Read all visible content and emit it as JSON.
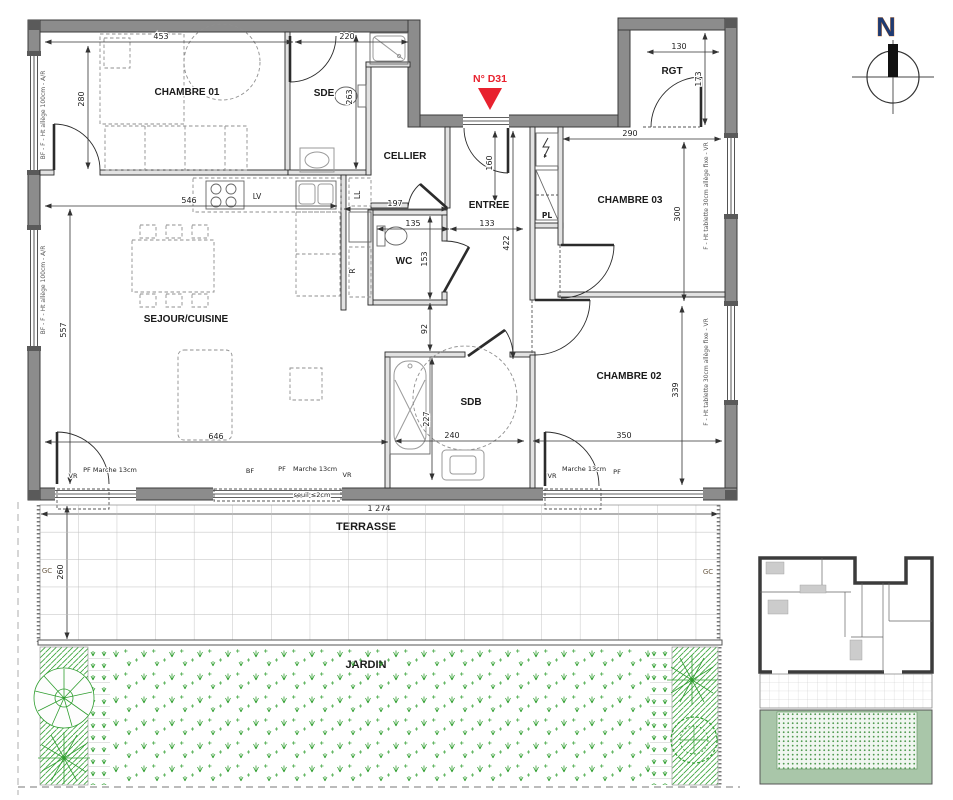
{
  "colors": {
    "wall_gray": "#8c8c8c",
    "marker_red": "#e8212e",
    "vegetation_green": "#2f9e2f",
    "north_blue": "#1f3b73"
  },
  "marker": {
    "label": "N° D31"
  },
  "compass": {
    "north": "N"
  },
  "rooms": {
    "chambre01": "CHAMBRE 01",
    "sde": "SDE",
    "cellier": "CELLIER",
    "entree": "ENTREE",
    "pl": "PL",
    "rgt": "RGT",
    "chambre03": "CHAMBRE 03",
    "wc": "WC",
    "sejour": "SEJOUR/CUISINE",
    "sdb": "SDB",
    "chambre02": "CHAMBRE 02",
    "terrasse": "TERRASSE",
    "jardin": "JARDIN"
  },
  "appliances": {
    "ll": "LL",
    "lv": "LV",
    "refrigerator": "R"
  },
  "dimensions": {
    "d453": "453",
    "d220": "220",
    "d280": "280",
    "d130": "130",
    "d173": "173",
    "d290": "290",
    "d300": "300",
    "d546": "546",
    "d557": "557",
    "d646": "646",
    "d263": "263",
    "d197": "197",
    "d160": "160",
    "d133": "133",
    "d135": "135",
    "d422": "422",
    "d153": "153",
    "d92": "92",
    "d227": "227",
    "d240": "240",
    "d339": "339",
    "d350": "350",
    "d1274": "1 274",
    "d260": "260"
  },
  "openings": {
    "vr": "VR",
    "pf_marche": "PF Marche 13cm",
    "bf": "BF",
    "pf": "PF",
    "marche": "Marche 13cm",
    "seuil": "seuil ≤2cm",
    "gc": "GC"
  },
  "window_notes": {
    "left": "BF - F - Ht allège 100cm - A/R",
    "right": "F - Ht tablette 30cm allège fixe - VR"
  }
}
